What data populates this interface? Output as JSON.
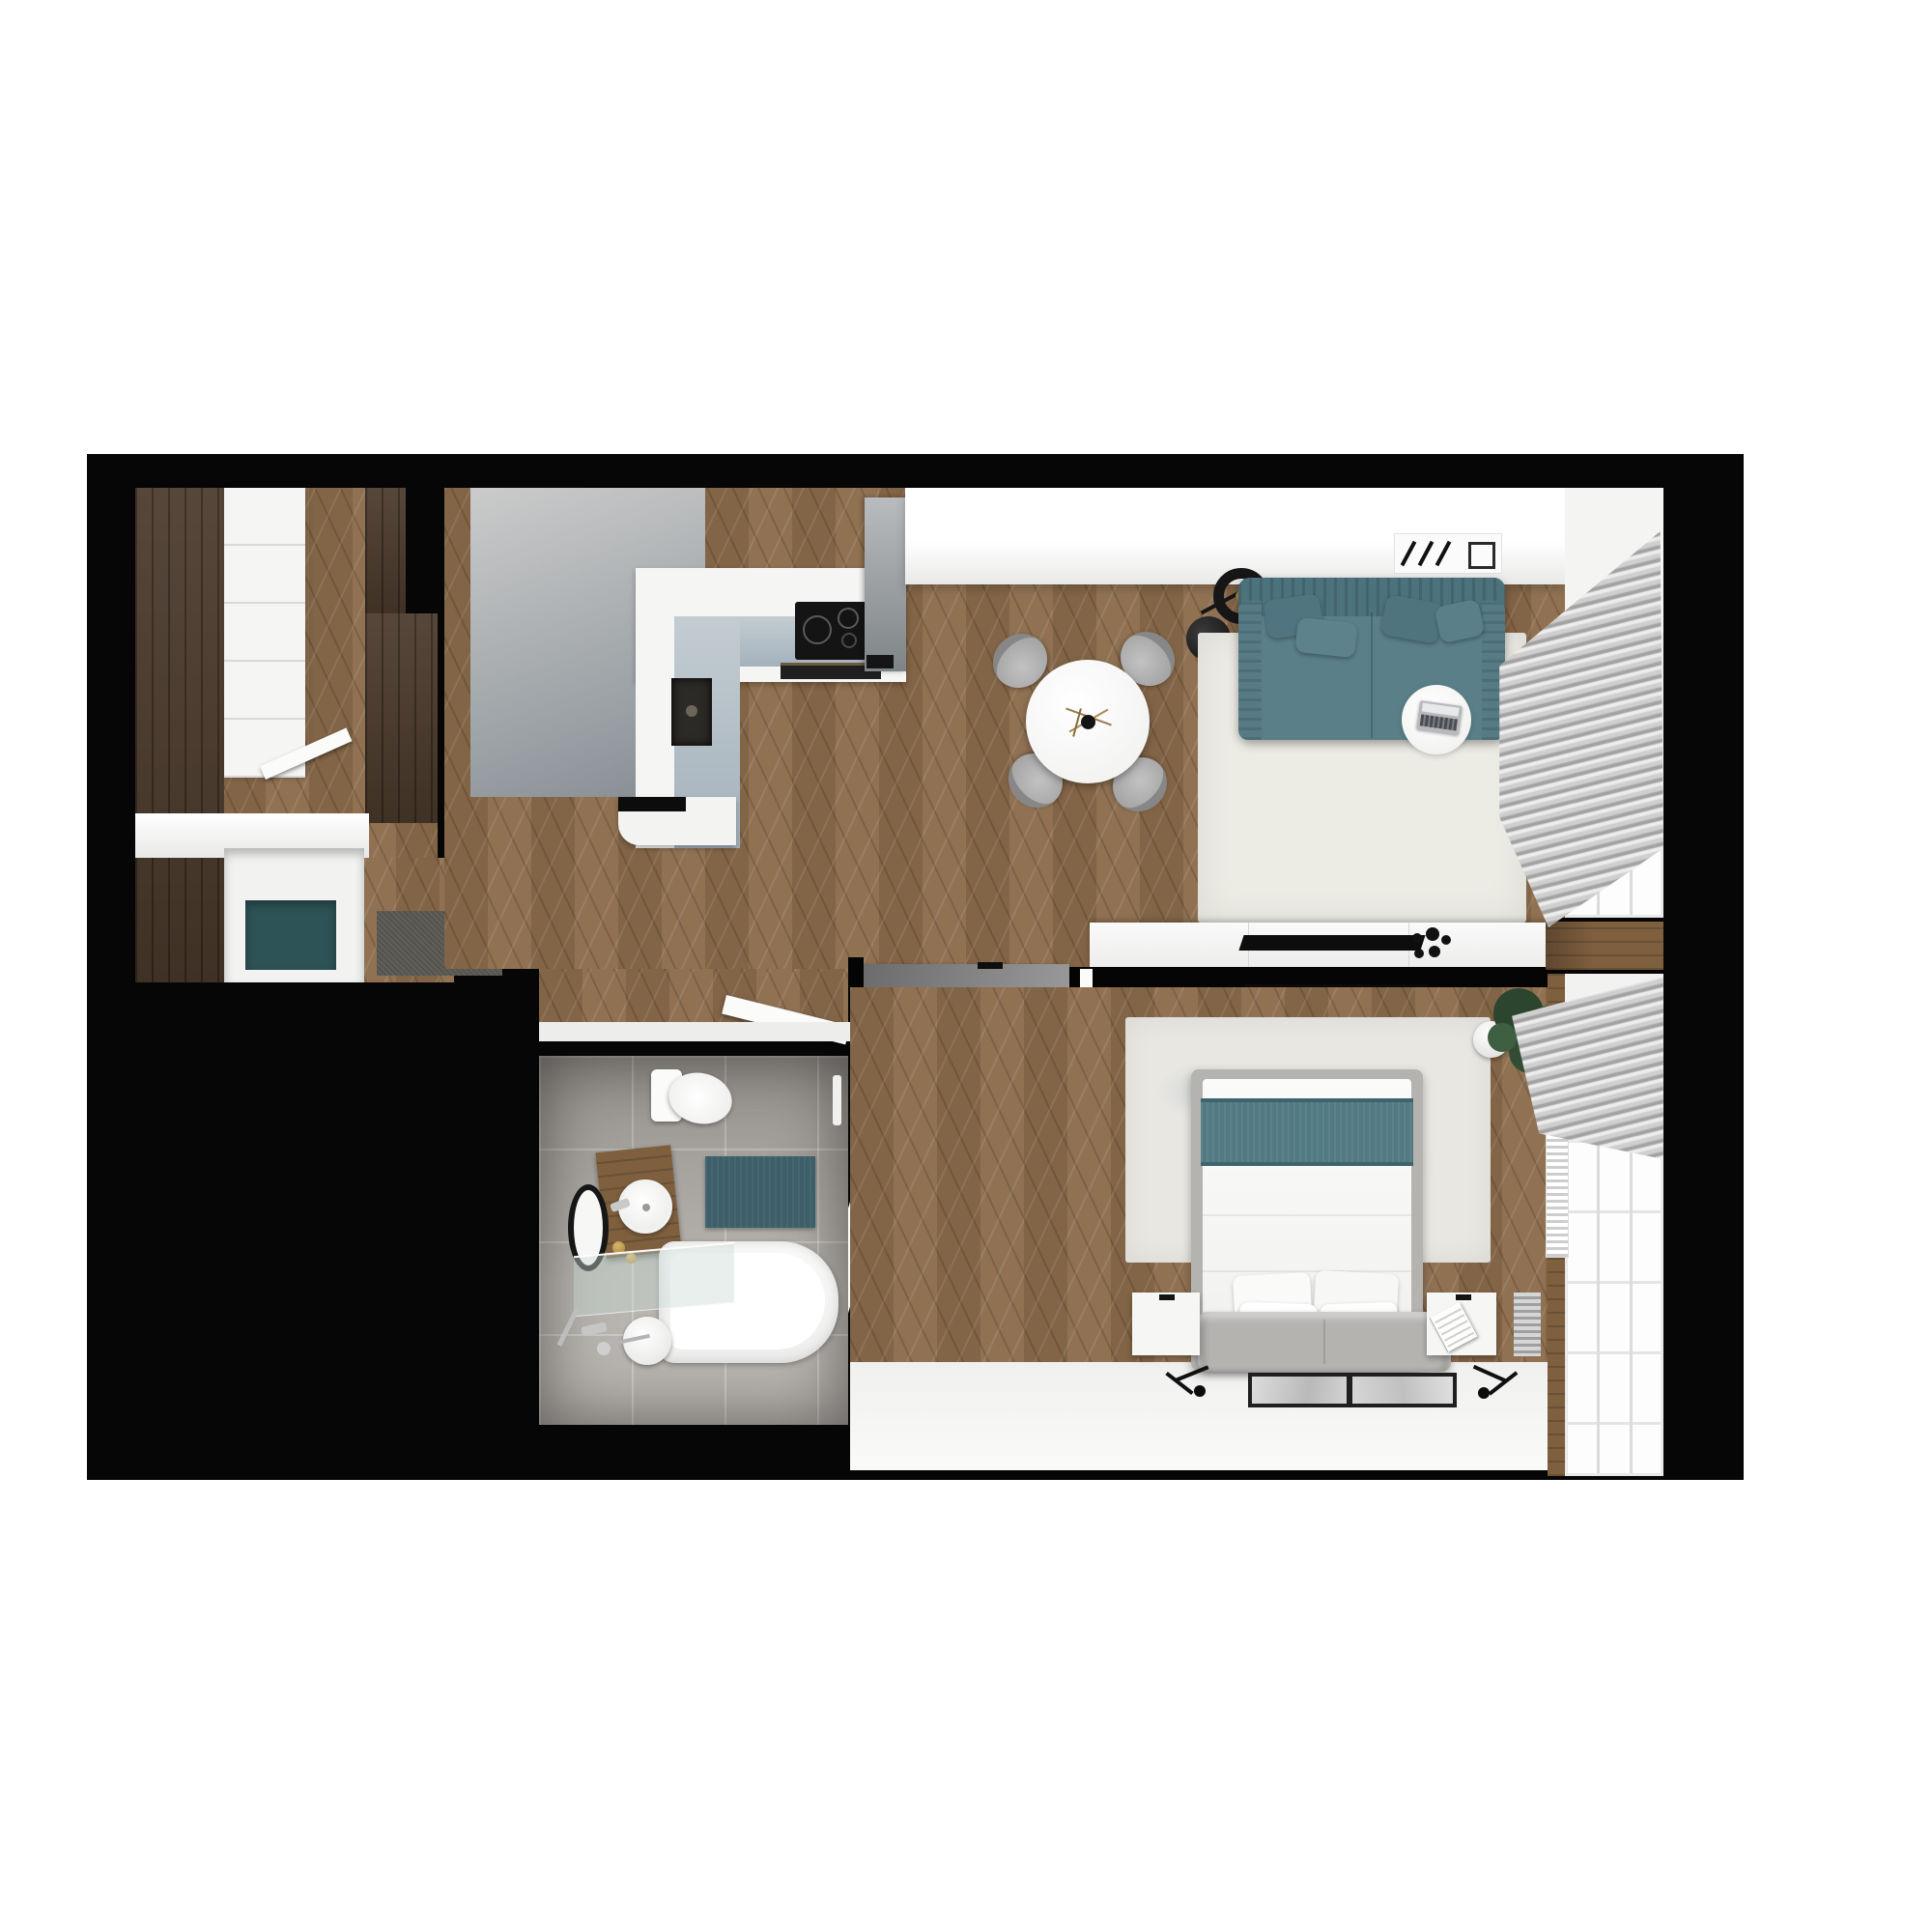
{
  "scene": {
    "type": "3d-floor-plan-render",
    "view": "top-down",
    "description": "Rendered top view of a one-bedroom apartment on a black wall mask over a white page"
  },
  "colors": {
    "page": "#ffffff",
    "plan": "#060606",
    "wood": "#8a6a4a",
    "wood_dark": "#4a392b",
    "wood_mid": "#7e5f3e",
    "gray_wall": "#9aa0a4",
    "white_wall": "#f5f5f4",
    "counter_band": "#a4b2bc",
    "teal_sofa": "#5a7f89",
    "teal_dark": "#4c727c",
    "teal_band": "#527a83",
    "teal_bench": "#2e5356",
    "teal_mat": "#3c5f69",
    "rug_living": "#ecebe4",
    "rug_bedroom": "#e8e7e2",
    "tile": "#aaa6a0",
    "doormat": "#55534e",
    "gray_wardrobe": "#7d7d7d",
    "dresser": "#d9d9d8",
    "bed_frame": "#b5b3b0",
    "curtain_a": "#cfcfcf",
    "curtain_b": "#a2a2a2",
    "gold": "#a8863f",
    "appliance": "#141414"
  },
  "rooms": [
    {
      "id": "entry-dressing",
      "name": "Entry / dressing room",
      "furniture": [
        "dark wood wardrobes",
        "white sliding wardrobe",
        "teal bench nook",
        "gray doormat",
        "open door"
      ]
    },
    {
      "id": "kitchen",
      "name": "Kitchen",
      "furniture": [
        "L-shaped white counter",
        "induction cooktop",
        "undermount sink",
        "oven front",
        "tall gray unit",
        "gray feature wall"
      ]
    },
    {
      "id": "dining",
      "name": "Dining area",
      "furniture": [
        "round white table",
        "black vase with twigs",
        "4 gray chairs",
        "black floor lamp"
      ]
    },
    {
      "id": "living",
      "name": "Living room",
      "furniture": [
        "teal sofa with pillows",
        "round side table",
        "laptop",
        "cream rug",
        "TV sideboard",
        "flat TV",
        "ceiling AC vent",
        "gray curtains",
        "radiator"
      ]
    },
    {
      "id": "bedroom-hall",
      "name": "Bedroom hallway",
      "furniture": [
        "dark gray wardrobe",
        "light dresser",
        "open white doors"
      ]
    },
    {
      "id": "bedroom",
      "name": "Bedroom",
      "furniture": [
        "bed with teal runner",
        "4 white pillows",
        "gray foot bench",
        "2 white nightstands",
        "open book",
        "2 floor pictures",
        "2 black wall lamps",
        "distressed rug",
        "potted plant",
        "radiator",
        "wall TV",
        "gray curtains"
      ]
    },
    {
      "id": "bathroom",
      "name": "Bathroom",
      "furniture": [
        "toilet",
        "wood vanity",
        "round vessel sink",
        "round black mirror",
        "teal mat",
        "bathtub",
        "glass screen",
        "shower fittings",
        "paper holder"
      ]
    }
  ],
  "windows": {
    "position": "right wall",
    "count": 2,
    "separator": "wood balcony band",
    "radiators": 3
  }
}
